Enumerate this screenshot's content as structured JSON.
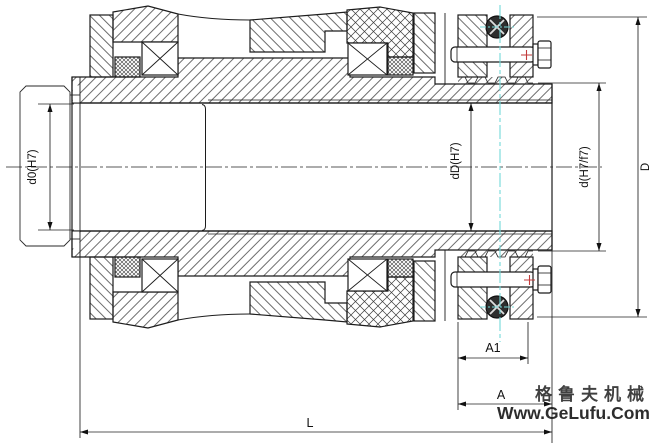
{
  "drawing": {
    "dimension_labels": {
      "shaft_bore_left": "d0(H7)",
      "hub_bore": "dD(H7)",
      "hub_fit": "d(H7/f7)",
      "outer_diameter": "D",
      "clamp_width": "A1",
      "hub_end_width": "A",
      "total_length": "L"
    },
    "watermark": {
      "brand": "格鲁夫机械",
      "url": "Www.GeLufu.Com",
      "brand_color": "#de8080",
      "url_color": "#d24a4a"
    },
    "colors": {
      "line": "#1c1c1c",
      "hatch": "#3c3c3c",
      "centerline_cyan": "#74d9d9",
      "marker_red": "#c23b3b",
      "background": "#ffffff"
    }
  }
}
